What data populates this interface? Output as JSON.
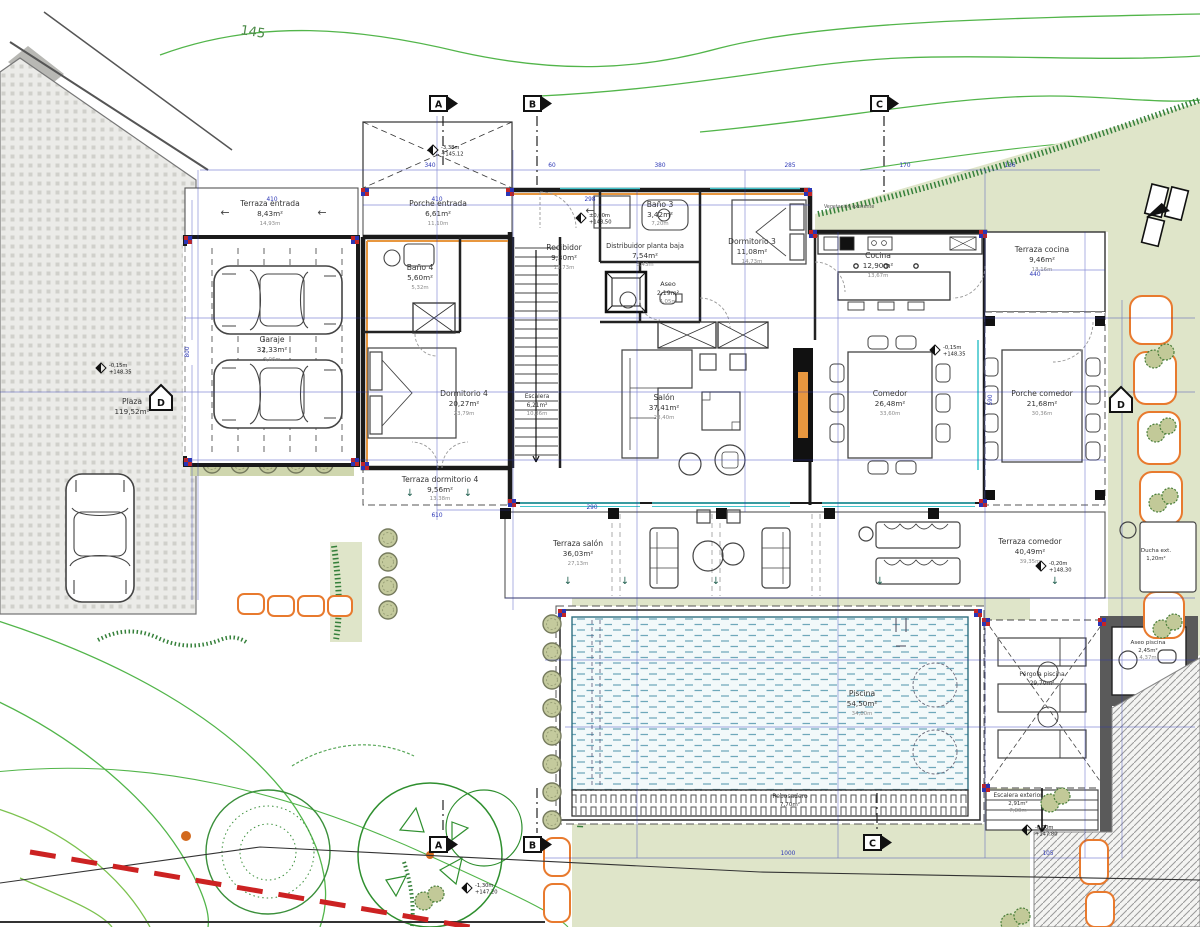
{
  "drawing": {
    "type": "floor-plan",
    "contour_label": "145",
    "vegetation_note": "Vegetación existente"
  },
  "rooms": {
    "terraza_entrada": {
      "name": "Terraza entrada",
      "area": "8,43m²",
      "sub": "14,93m"
    },
    "porche_entrada": {
      "name": "Porche entrada",
      "area": "6,61m²",
      "sub": "11,10m"
    },
    "garaje": {
      "name": "Garaje",
      "area": "32,33m²",
      "sub": "9,06m"
    },
    "bano4": {
      "name": "Baño 4",
      "area": "5,60m²",
      "sub": "5,32m"
    },
    "dormitorio4": {
      "name": "Dormitorio 4",
      "area": "20,27m²",
      "sub": "23,79m"
    },
    "terraza_dormitorio4": {
      "name": "Terraza dormitorio 4",
      "area": "9,56m²",
      "sub": "13,38m"
    },
    "recibidor": {
      "name": "Recibidor",
      "area": "9,30m²",
      "sub": "13,73m"
    },
    "escalera": {
      "name": "Escalera",
      "area": "6,21m²",
      "sub": "10,36m"
    },
    "distribuidor": {
      "name": "Distribuidor planta baja",
      "area": "7,54m²",
      "sub": "3,43m"
    },
    "bano3": {
      "name": "Baño 3",
      "area": "3,42m²",
      "sub": "7,20m"
    },
    "aseo": {
      "name": "Aseo",
      "area": "2,19m²",
      "sub": "4,05m"
    },
    "dormitorio3": {
      "name": "Dormitorio 3",
      "area": "11,08m²",
      "sub": "14,73m"
    },
    "salon": {
      "name": "Salón",
      "area": "37,41m²",
      "sub": "28,40m"
    },
    "cocina": {
      "name": "Cocina",
      "area": "12,90m²",
      "sub": "13,67m"
    },
    "terraza_cocina": {
      "name": "Terraza cocina",
      "area": "9,46m²",
      "sub": "13,16m"
    },
    "comedor": {
      "name": "Comedor",
      "area": "26,48m²",
      "sub": "33,60m"
    },
    "porche_comedor": {
      "name": "Porche comedor",
      "area": "21,68m²",
      "sub": "30,36m"
    },
    "terraza_salon": {
      "name": "Terraza salón",
      "area": "36,03m²",
      "sub": "27,13m"
    },
    "terraza_comedor": {
      "name": "Terraza comedor",
      "area": "40,49m²",
      "sub": "39,35m"
    },
    "piscina": {
      "name": "Piscina",
      "area": "54,50m²",
      "sub": "34,80m"
    },
    "rebosadero": {
      "name": "Rebosadero",
      "area": "7,70m²"
    },
    "pergola": {
      "name": "Pérgola piscina",
      "area": "29,70m²"
    },
    "aseo_piscina": {
      "name": "Aseo piscina",
      "area": "2,45m²",
      "sub": "4,37m"
    },
    "escalera_exterior": {
      "name": "Escalera exterior",
      "area": "2,91m²",
      "sub": "7,80m"
    },
    "ducha_ext": {
      "name": "Ducha ext.",
      "area": "1,20m²"
    },
    "plaza": {
      "name": "Plaza",
      "area": "119,52m²"
    }
  },
  "levels": {
    "recibidor": {
      "v1": "±0,00m",
      "v2": "+148,50"
    },
    "entrada": {
      "v1": "-3,38m",
      "v2": "+145,12"
    },
    "plaza": {
      "v1": "-0,15m",
      "v2": "+148,35"
    },
    "terraza": {
      "v1": "-0,20m",
      "v2": "+148,30"
    },
    "lateral": {
      "v1": "-0,15m",
      "v2": "+148,35"
    },
    "jardin": {
      "v1": "-0,70m",
      "v2": "+147,80"
    },
    "jardin_bajo": {
      "v1": "-1,30m",
      "v2": "+147,20"
    }
  },
  "markers": {
    "a": "A",
    "b": "B",
    "c": "C",
    "d": "D"
  },
  "dims": {
    "d1": "340",
    "d2": "60",
    "d3": "380",
    "d4": "285",
    "d5": "170",
    "d6": "136",
    "d7": "410",
    "d8": "410",
    "d9": "298",
    "d10": "800",
    "d11": "590",
    "d12": "610",
    "d13": "440",
    "d14": "1000",
    "d15": "105",
    "d16": "290"
  },
  "colors": {
    "dimension_blue": "#2a35b5",
    "wall_black": "#1a1a1a",
    "insulation_orange": "#e8973f",
    "glazing_cyan": "#45c6cd",
    "contour_green": "#52b54a",
    "garden_olive": "#dfe5c9",
    "hedge_green": "#35803a",
    "pool_teal": "#6ea8ba",
    "stone_orange": "#e87a2e",
    "boundary_red": "#cc2222"
  }
}
